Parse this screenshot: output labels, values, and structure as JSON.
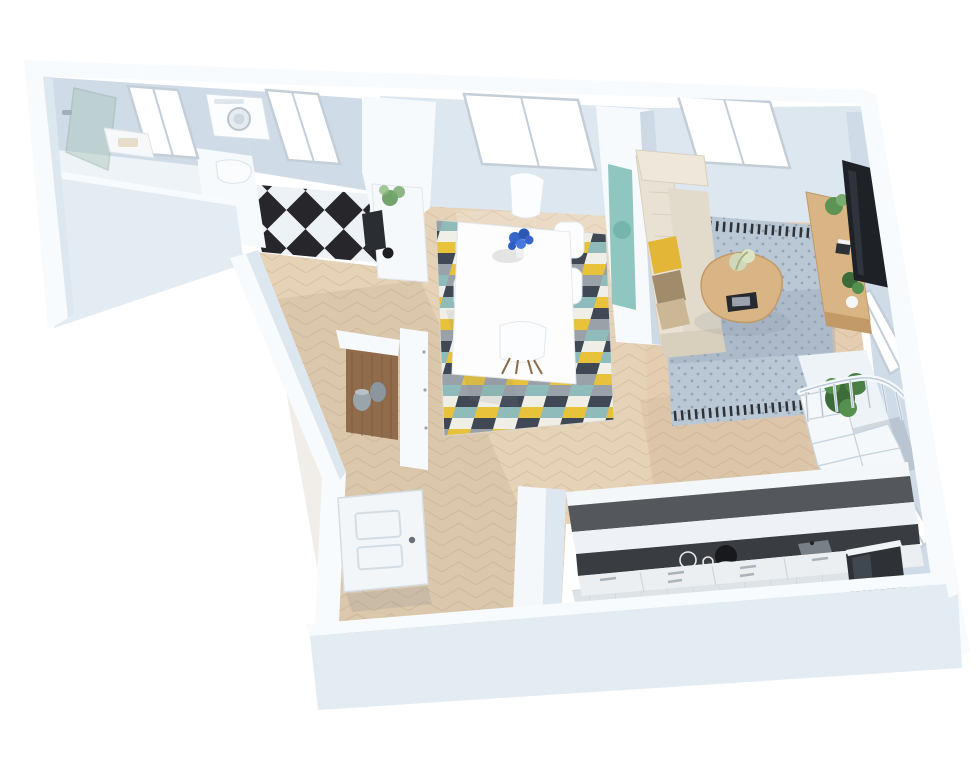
{
  "scene": {
    "kind": "3d-floorplan-render",
    "view": "isometric-top",
    "background": "#ffffff"
  },
  "palette": {
    "bg": "#ffffff",
    "wallTop": "#f8fbfd",
    "wallFace": "#cfdce8",
    "wallFaceLight": "#dde7f0",
    "wallExterior": "#e3ebf3",
    "windowGlass": "#ffffff",
    "windowFrame": "#c3ced8",
    "floorWood": "#e6d2b7",
    "floorWoodLine": "#d5bf9f",
    "floorWoodWarm": "#e2c6ab",
    "closetWood": "#8f6847",
    "checkerDark": "#26262b",
    "checkerLight": "#edf2f6",
    "tileFloor": "#dde3e7",
    "tileLine": "#c9d1d6",
    "barTop": "#54585d",
    "worktopDark": "#393d42",
    "cabinetWhite": "#eceff2",
    "applianceDark": "#2e3237",
    "tvScreen": "#1e2126",
    "woodFurniture": "#d9b586",
    "woodFurnitureDark": "#c19a67",
    "sofaBeige": "#e9e2d4",
    "sofaShade": "#d8cfbc",
    "pillowYellow": "#e3b637",
    "pillowBrown": "#a08b6a",
    "rugLivingBase": "#bac7d5",
    "rugLivingDark": "#93a4b6",
    "rugBorder": "#2f3338",
    "rugDiningColors": [
      "#f0efe7",
      "#8fbcba",
      "#3f4854",
      "#e8c23a",
      "#9ba1a8"
    ],
    "plantGreen": "#3e6b3a",
    "plantGreenLight": "#5d9453",
    "glassShower": "#aac4b8",
    "flowerBlue": "#3566c9",
    "doorWhite": "#f2f6f9",
    "shadow": "rgba(120,132,145,0.28)"
  },
  "rooms": [
    {
      "id": "bathroom",
      "features": [
        "glass-shower",
        "vanity",
        "window"
      ]
    },
    {
      "id": "laundry-wc",
      "features": [
        "washing-machine",
        "toilet",
        "checkered-floor",
        "window"
      ]
    },
    {
      "id": "hallway",
      "features": [
        "storage-nook",
        "baskets"
      ]
    },
    {
      "id": "dining-room",
      "features": [
        "table",
        "six-chairs",
        "geometric-rug",
        "sideboard",
        "plant",
        "wall-art",
        "window"
      ]
    },
    {
      "id": "living-room",
      "features": [
        "sofa",
        "pillows",
        "patterned-rug",
        "coffee-table",
        "tablet",
        "media-console",
        "tv",
        "plants",
        "two-windows"
      ]
    },
    {
      "id": "staircase",
      "features": [
        "winder-stairs",
        "railing",
        "plants"
      ]
    },
    {
      "id": "kitchen",
      "features": [
        "bar-wall",
        "cooktop",
        "hood",
        "drawer-cabinets",
        "tall-fridge",
        "tile-floor"
      ]
    },
    {
      "id": "entry",
      "features": [
        "open-front-door",
        "herringbone-floor"
      ]
    }
  ],
  "counts": {
    "dining_chairs": 6,
    "windows_north": 4,
    "windows_east": 2,
    "sofa_pillows": 3
  }
}
